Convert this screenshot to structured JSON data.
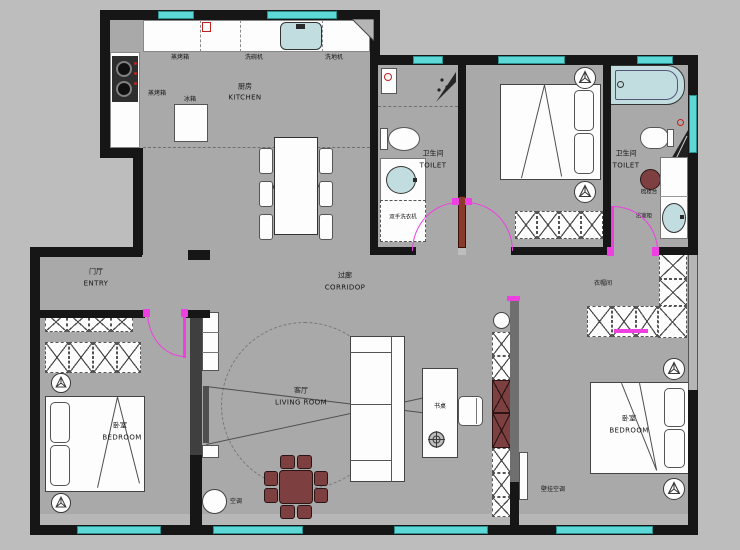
{
  "title": "apartment-floor-plan",
  "colors": {
    "background": "#bdbdbd",
    "floor": "#a9a9a9",
    "wall": "#161616",
    "window": "#5ed7d7",
    "door": "#ee3fe0",
    "wood_accent": "#7d4040",
    "water_fixture": "#c2dde0"
  },
  "rooms": {
    "kitchen": {
      "zh": "厨房",
      "en": "KITCHEN"
    },
    "dining": {
      "en": "DINING ROOM"
    },
    "toilet_left": {
      "zh": "卫生间",
      "en": "TOILET"
    },
    "toilet_right": {
      "zh": "卫生间",
      "en": "TOILET"
    },
    "corridor": {
      "zh": "过廊",
      "en": "CORRIDOP"
    },
    "living": {
      "zh": "客厅",
      "en": "LIVING ROOM"
    },
    "entry": {
      "zh": "门厅",
      "en": "ENTRY"
    },
    "bedroom_left": {
      "zh": "卧室",
      "en": "BEDROOM"
    },
    "bedroom_right": {
      "zh": "卧室",
      "en": "BEDROOM"
    },
    "cloakroom": {
      "zh": "衣帽间"
    }
  },
  "fixtures": {
    "steam_oven_counter": "蒸烤箱",
    "dishwasher": "洗碗机",
    "floor_scrubber": "洗地机",
    "steam_oven_side": "蒸烤箱",
    "fridge": "冰箱",
    "hand_washer": "双手洗衣机",
    "dressing_table": "梳妆台",
    "bath_cabinet": "浴室柜",
    "desk": "书桌",
    "floor_ac": "空调",
    "wall_ac": "壁挂空调"
  }
}
